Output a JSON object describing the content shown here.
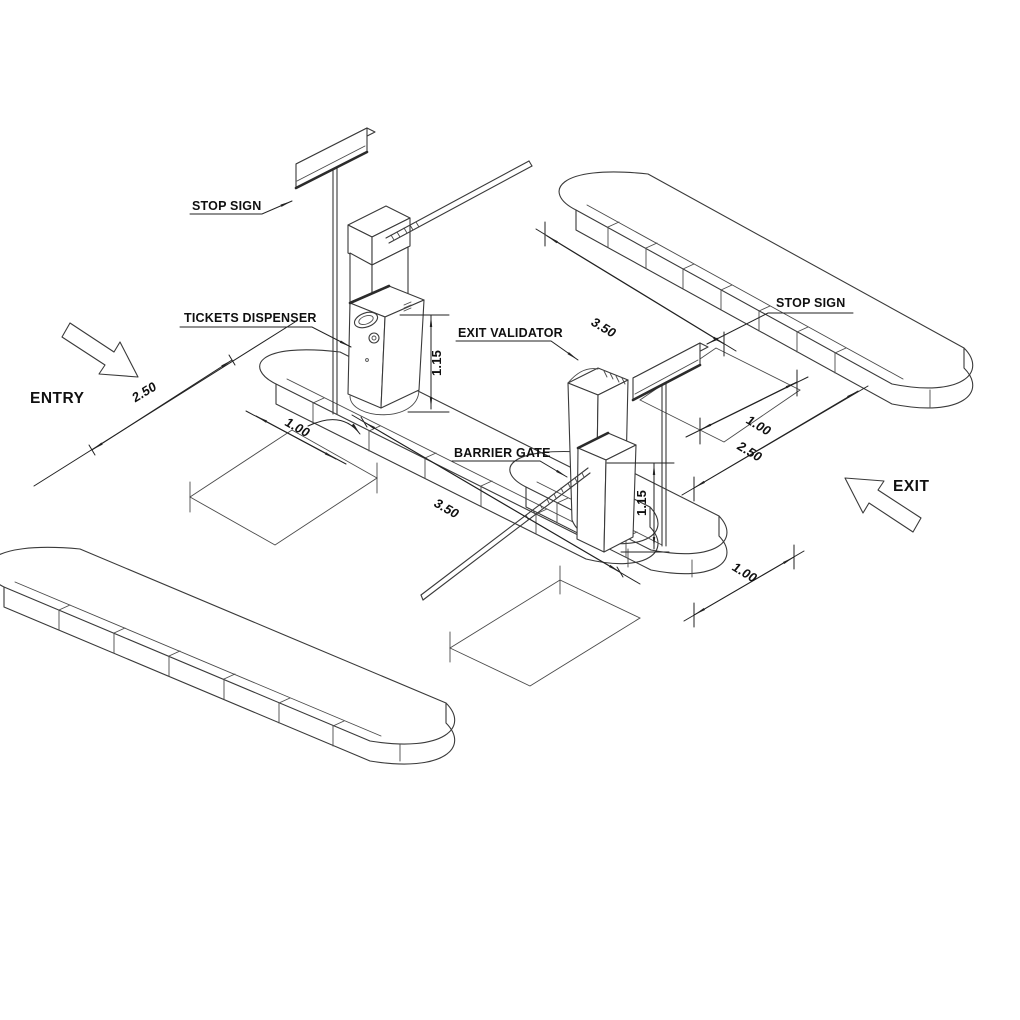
{
  "drawing": {
    "title": "Parking entry and exit lane isometric detail",
    "labels": {
      "entry_stop_sign": "STOP SIGN",
      "tickets_dispenser": "TICKETS DISPENSER",
      "exit_validator": "EXIT VALIDATOR",
      "barrier_gate": "BARRIER GATE",
      "exit_stop_sign": "STOP SIGN",
      "entry_direction": "ENTRY",
      "exit_direction": "EXIT"
    },
    "dimensions": {
      "entry_lane_width": "2.50",
      "entry_loop_offset": "1.00",
      "entry_lane_length": "3.50",
      "dispenser_height": "1.15",
      "exit_lane_length": "3.50",
      "exit_loop_offset": "1.00",
      "exit_lane_width": "2.50",
      "validator_height": "1.15",
      "exit_island_clearance": "1.00"
    },
    "style": {
      "background": "#ffffff",
      "line_color": "#3a3a3a",
      "dimension_color": "#222222",
      "text_color": "#101010"
    }
  }
}
